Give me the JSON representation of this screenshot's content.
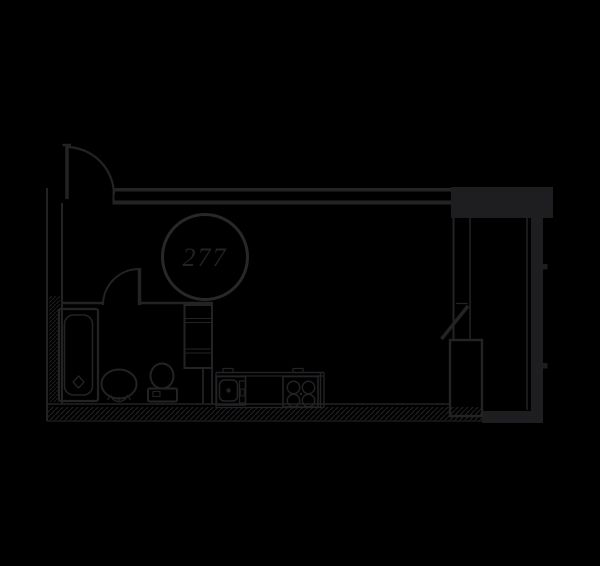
{
  "colors": {
    "background": "#000000",
    "line": "#232326",
    "wall_fill": "#1e1e20",
    "hatch": "#1f1f21",
    "circle_stroke": "#28282a",
    "unit_text": "#232325"
  },
  "floor_plan": {
    "unit_circle": {
      "label": "277"
    },
    "fixtures": [
      "entry-door",
      "bathroom-door",
      "bathtub",
      "pedestal-sink",
      "toilet",
      "shelving-unit",
      "kitchen-sink",
      "cooktop",
      "tall-cabinet",
      "closet-door",
      "window-wall",
      "hatched-exterior-wall"
    ]
  }
}
